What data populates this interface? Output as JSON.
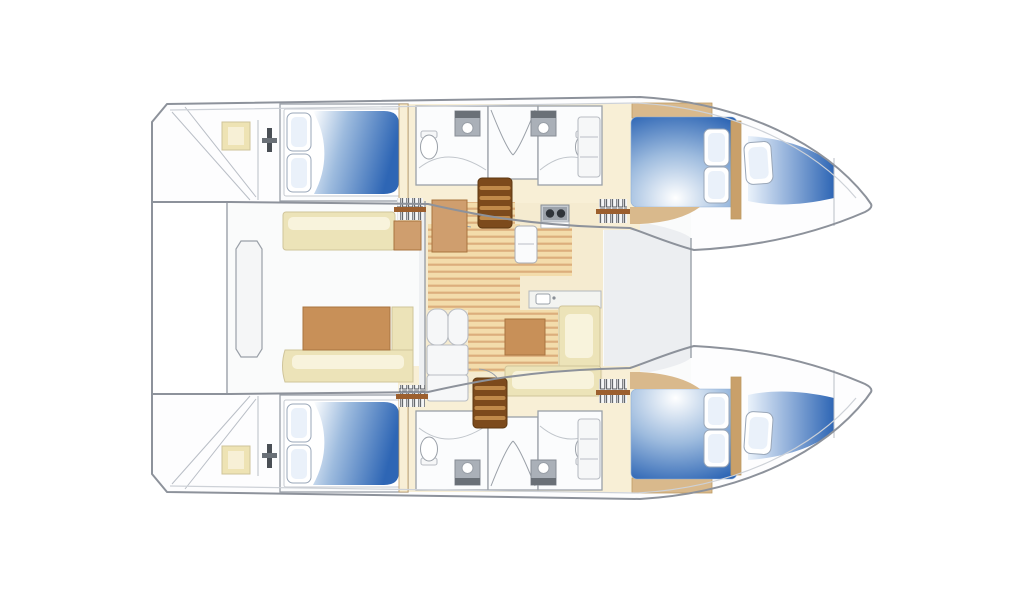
{
  "plan": {
    "vessel_type": "catamaran-floor-plan",
    "orientation": "bow-right",
    "hulls": [
      "port-hull-top",
      "starboard-hull-bottom"
    ],
    "rooms": [
      "port-aft-cabin",
      "port-bathroom-aft",
      "port-shower-stall",
      "port-bathroom-fwd",
      "port-forward-cabin",
      "port-forepeak-berth",
      "starboard-aft-cabin",
      "starboard-bathroom-aft",
      "starboard-shower-stall",
      "starboard-bathroom-fwd",
      "starboard-forward-cabin",
      "starboard-forepeak-berth",
      "salon",
      "galley",
      "cockpit",
      "foredeck",
      "aft-platform-port",
      "aft-platform-starboard"
    ],
    "furniture_counts": {
      "double_beds": 4,
      "forepeak_berths": 2,
      "bathrooms": 4,
      "shower_stalls": 2,
      "toilets": 4,
      "sinks": 4,
      "companionway_steps": 4,
      "pillows": 10
    }
  },
  "colors": {
    "outline": "#8d929b",
    "hull_white": "#fdfdfe",
    "bridge_floor": "#fafbfb",
    "foredeck_gray": "#eceef1",
    "hull_interior": "#f8efd6",
    "salon_floor": "#f5ebd0",
    "plank_base": "#f3dcab",
    "plank_line": "#dcae7c",
    "bench": "#ece3b8",
    "bench_highlight": "#f8f3dc",
    "table_brown": "#c89058",
    "nav_brown": "#cf9e6e",
    "wood_trim": "#c9a06a",
    "wood_shelf": "#d9b98c",
    "barrel_dark": "#7c4a1c",
    "barrel_band": "#c08a4a",
    "bed_blue": "#2e66b5",
    "bed_blue_mid": "#9dbbde",
    "bed_white": "#ffffff",
    "pillow_fill": "#eaf1fa",
    "steps_bar": "#9c5f2e",
    "steps_slat": "#f4f5f6",
    "sink_gray": "#aab0b8",
    "appliance_gray": "#c6cbd1",
    "burner_dark": "#2f343a",
    "hatch_tan": "#eee3b4",
    "hatch_tan_light": "#f7f0d6"
  }
}
